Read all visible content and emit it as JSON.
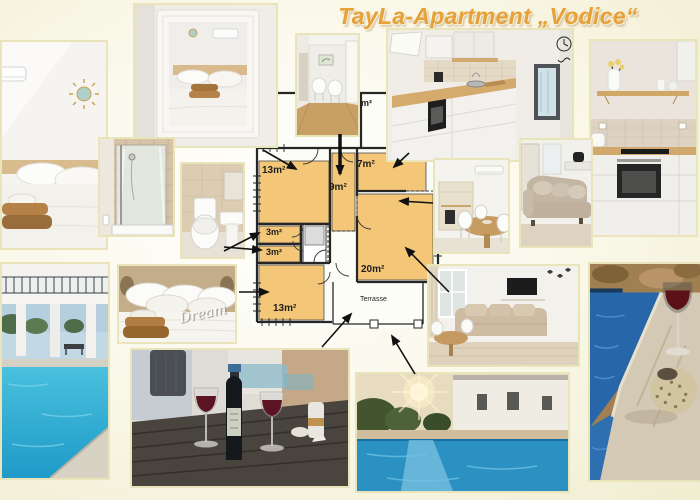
{
  "title": "TayLa-Apartment „Vodice“",
  "colors": {
    "title_accent": "#E6A138",
    "room_fill": "#F4C778",
    "background_edge": "#F0EDD0",
    "photo_frame": "#E9E4BA",
    "arrow": "#111111"
  },
  "floor_plan": {
    "rooms": {
      "bedroom_top": "13m²",
      "hallway": "9m²",
      "kitchen": "7m²",
      "store_1": "3m²",
      "store_2": "3m²",
      "living_room": "20m²",
      "bedroom_bottom": "13m²",
      "bathroom": "4m²",
      "terrace": "Terrasse"
    }
  },
  "photos": {
    "dream_sign": "Dream"
  }
}
